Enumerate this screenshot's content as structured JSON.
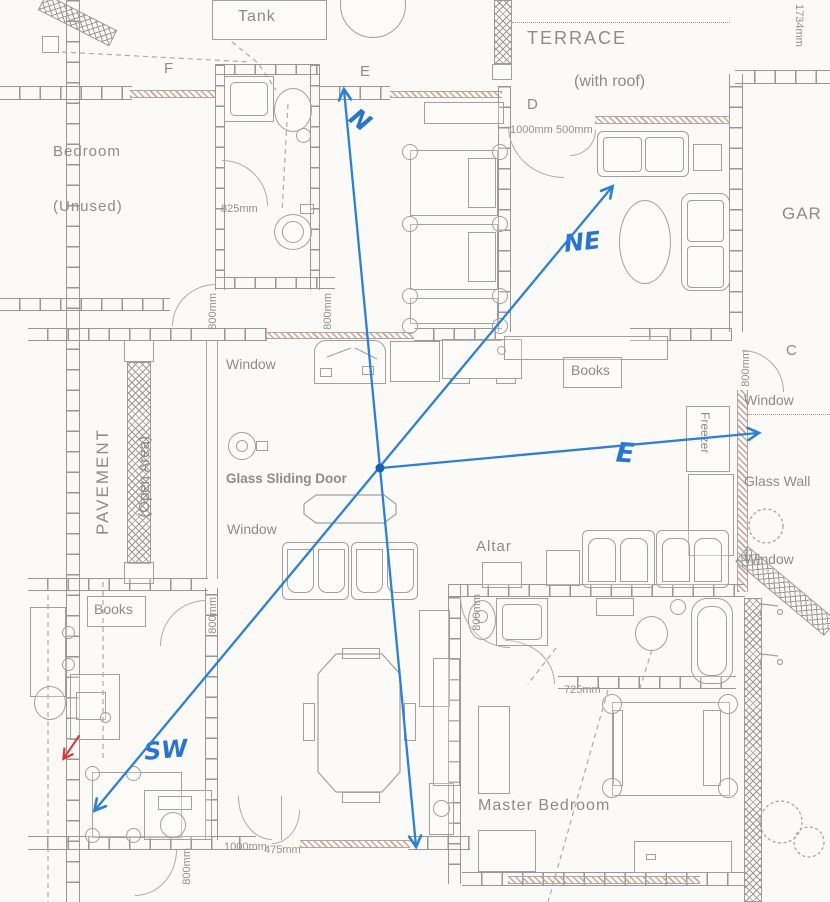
{
  "colors": {
    "blue": "#2e7fd6",
    "blue_dark": "#1c5fb4",
    "red": "#d23b3b",
    "ink": "#8c8c8c"
  },
  "compass": {
    "n": "N",
    "ne": "NE",
    "e": "E",
    "sw": "SW"
  },
  "letters": {
    "f": "F",
    "e": "E",
    "d": "D",
    "c": "C"
  },
  "rooms": {
    "tank": "Tank",
    "terrace": "TERRACE",
    "terrace_note": "(with roof)",
    "bedroom": "Bedroom",
    "bedroom_note": "(Unused)",
    "pavement": "PAVEMENT",
    "pavement_note": "(Open Area)",
    "master_bedroom": "Master Bedroom",
    "garden": "GAR",
    "altar": "Altar"
  },
  "features": {
    "window": "Window",
    "glass_sliding_door": "Glass Sliding Door",
    "glass_wall": "Glass Wall",
    "freezer": "Freezer",
    "books": "Books"
  },
  "measurements": {
    "m825": "825mm",
    "m1734": "1734mm",
    "m1000a": "1000mm",
    "m500": "500mm",
    "m1000b": "1000mm",
    "m475": "475mm",
    "m725": "725mm",
    "m800": "800mm"
  }
}
